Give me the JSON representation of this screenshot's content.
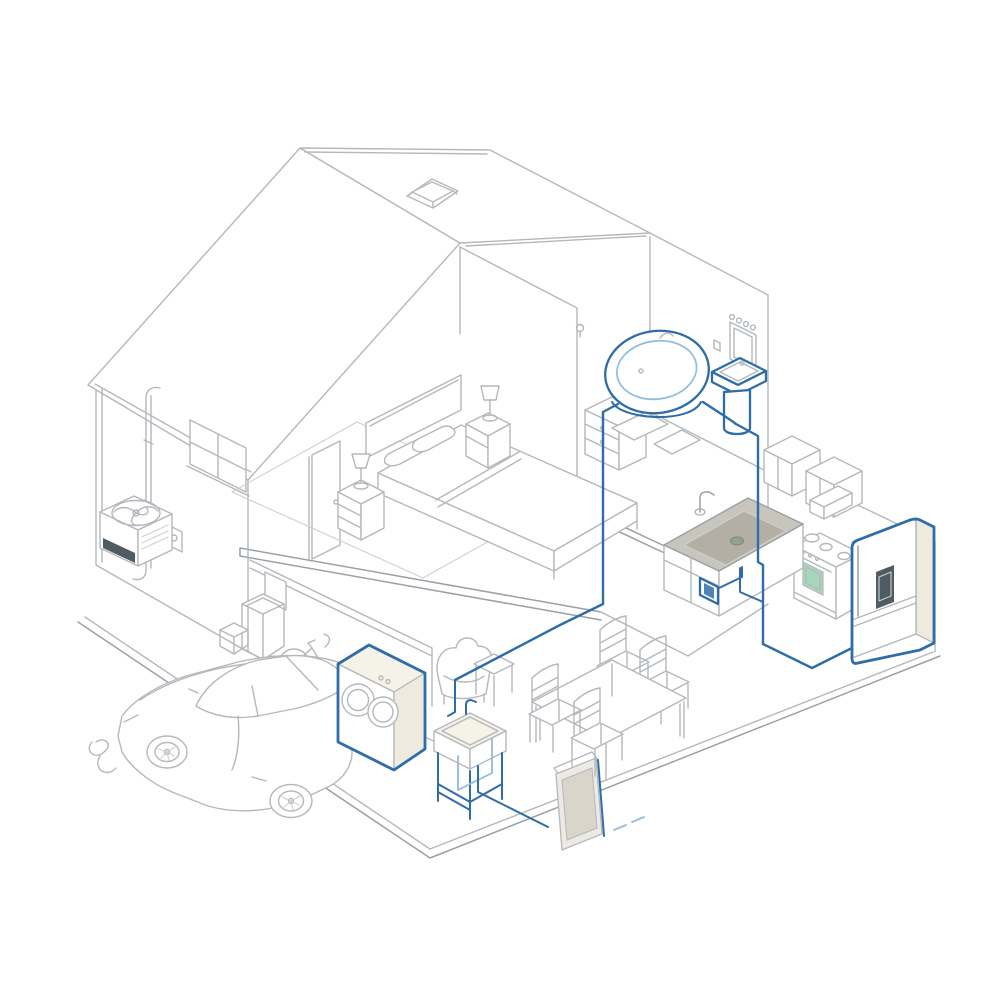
{
  "page": {
    "title": "Isometric house plumbing cutaway",
    "background": "#ffffff"
  },
  "illustration": {
    "aria_label": "Isometric line drawing of a cutaway two-story house showing blue water pipes connecting the bathtub, pedestal sink, kitchen sink, dishwasher, refrigerator, washer-dryer, utility sink and a wall heater panel; rooms include a garage with a sports car and bicycle, a bedroom with a double bed, a bathroom, a kitchen and a dining area.",
    "components": [
      "roof-with-skylight",
      "left-exterior-wall-window",
      "downspout",
      "electric-meter",
      "ac-condenser-unit",
      "garage",
      "sports-car",
      "bicycle",
      "trash-cans",
      "garage-hose",
      "bedroom",
      "double-bed",
      "pillows",
      "nightstands-with-lamps",
      "area-rug",
      "bedroom-door",
      "hall-dresser-with-tv",
      "bathroom",
      "bathtub",
      "bath-mats",
      "pedestal-sink",
      "medicine-cabinet-mirror",
      "wall-sconce",
      "kitchen",
      "upper-cabinets",
      "microwave-hood",
      "stove-oven",
      "kitchen-sink-counter",
      "dishwasher",
      "refrigerator",
      "dining-table",
      "dining-chairs",
      "wall-heater-panel",
      "living-armchair",
      "side-table",
      "washer-dryer",
      "utility-sink",
      "water-pipes"
    ]
  },
  "colors": {
    "background": "#ffffff",
    "line": "#b4b8bc",
    "line_dark": "#9aa0a5",
    "line_light": "#ccd0d3",
    "pipe": "#2e6da7",
    "pipe_light": "#94bcdb",
    "cream": "#f5f2e8",
    "cream_shade": "#eeeadd",
    "counter": "#c8c5bc",
    "counter_dark": "#989588",
    "green": "#a6d7bd",
    "panel": "#d9d5cb",
    "panel_light": "#edeae3",
    "dark": "#505c61",
    "accent_blue_fill": "#4d83b6"
  }
}
